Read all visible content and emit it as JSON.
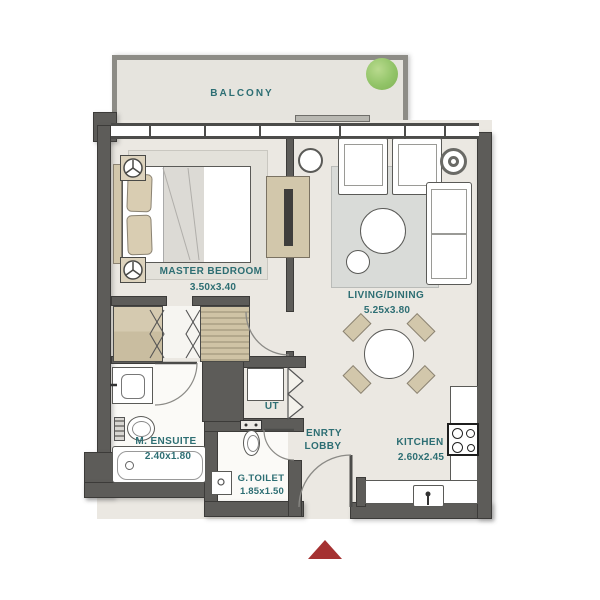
{
  "plan": {
    "type": "apartment-floor-plan",
    "rooms": {
      "balcony": {
        "label": "BALCONY"
      },
      "master_bedroom": {
        "label": "MASTER BEDROOM",
        "dimensions": "3.50x3.40"
      },
      "living_dining": {
        "label": "LIVING/DINING",
        "dimensions": "5.25x3.80"
      },
      "m_ensuite": {
        "label": "M. ENSUITE",
        "dimensions": "2.40x1.80"
      },
      "g_toilet": {
        "label": "G.TOILET",
        "dimensions": "1.85x1.50"
      },
      "utility": {
        "label": "UT"
      },
      "entry_lobby": {
        "label_line1": "ENRTY",
        "label_line2": "LOBBY"
      },
      "kitchen": {
        "label": "KITCHEN",
        "dimensions": "2.60x2.45"
      }
    },
    "icons": {
      "plant": "green-circle-plant-on-balcony",
      "ceiling_light": "circle-with-three-spokes",
      "entry_marker": "red-triangle-pointing-up"
    },
    "colors": {
      "wall": "#5d5c59",
      "floor": "#ebe8e2",
      "balcony_floor": "#e6e4de",
      "label_text": "#2d6e73",
      "furniture_tan": "#d2c7ab",
      "rug_gray": "#d9dbd8",
      "plant_green": "#8fc163",
      "entry_marker_red": "#a53131"
    }
  }
}
